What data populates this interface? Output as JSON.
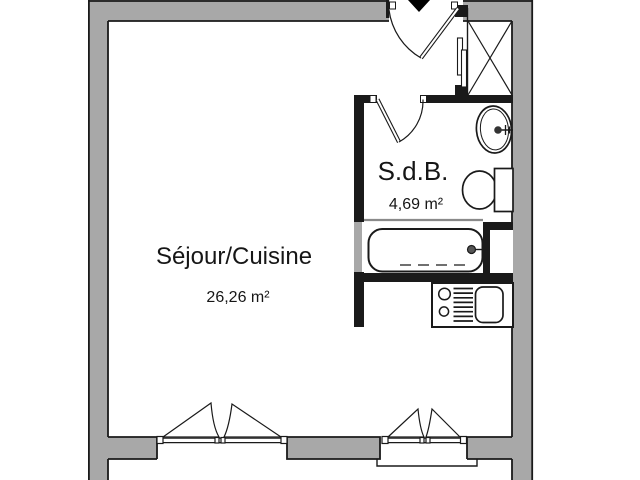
{
  "plan": {
    "type": "apartment-floor-plan",
    "colors": {
      "wall_fill": "#a8a8a8",
      "line": "#1a1a1a",
      "room_fill": "#ffffff"
    },
    "rooms": [
      {
        "name": "Séjour/Cuisine",
        "area": "26,26 m²"
      },
      {
        "name": "S.d.B.",
        "area": "4,69 m²"
      }
    ],
    "fixtures": [
      {
        "icon": "entrance-arrow-icon"
      },
      {
        "icon": "entrance-door-swing-icon"
      },
      {
        "icon": "closet-cross-icon"
      },
      {
        "icon": "sliding-door-icon"
      },
      {
        "icon": "bathroom-door-swing-icon"
      },
      {
        "icon": "washbasin-icon"
      },
      {
        "icon": "toilet-icon"
      },
      {
        "icon": "bathtub-icon"
      },
      {
        "icon": "technical-shaft-icon"
      },
      {
        "icon": "kitchen-hob-icon"
      },
      {
        "icon": "kitchen-drainer-icon"
      },
      {
        "icon": "kitchen-sink-icon"
      },
      {
        "icon": "casement-window-icon"
      },
      {
        "icon": "casement-window-icon"
      },
      {
        "icon": "window-ledge-icon"
      }
    ]
  }
}
